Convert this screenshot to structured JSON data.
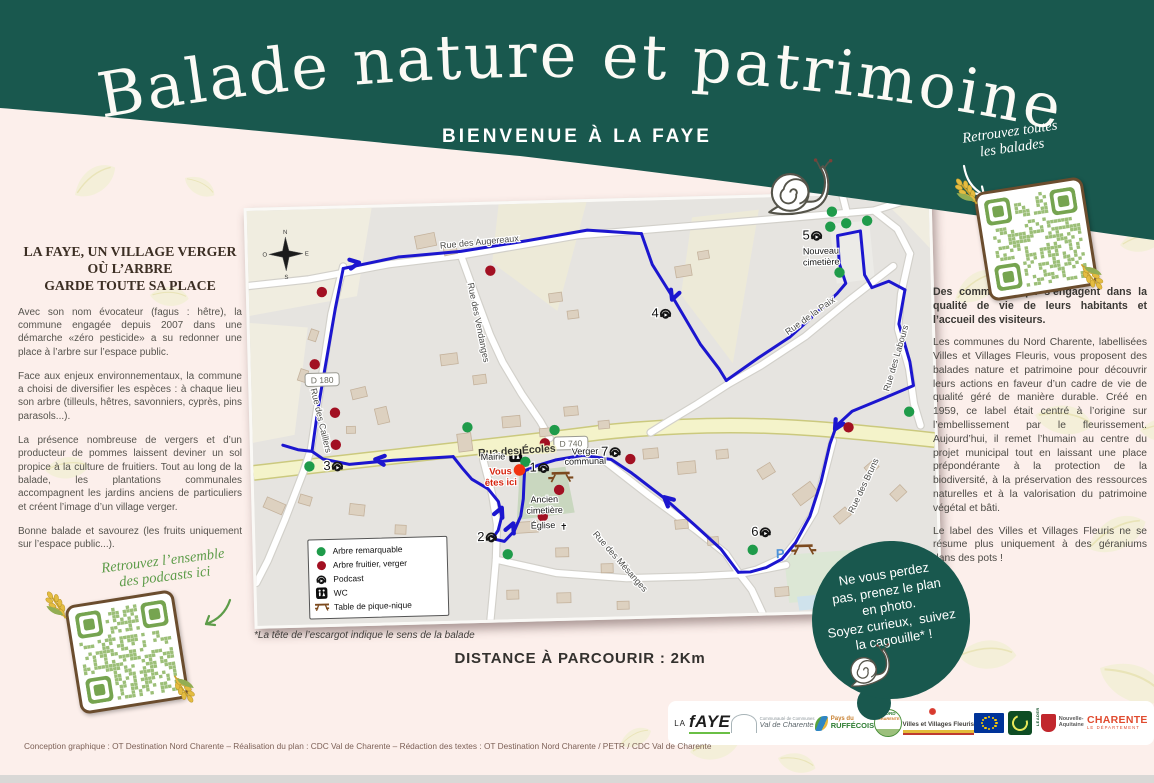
{
  "header": {
    "title": "Balade nature et patrimoine",
    "subtitle": "BIENVENUE À LA FAYE",
    "qr_note_lines": [
      "Retrouvez toutes",
      "les balades"
    ]
  },
  "left_panel": {
    "heading_lines": [
      "LA FAYE, UN VILLAGE VERGER",
      "OÙ L’ARBRE",
      "GARDE TOUTE SA PLACE"
    ],
    "paragraphs": [
      "Avec son nom évocateur (fagus : hêtre), la commune engagée depuis 2007 dans une démarche «zéro pesticide» a su redonner une place à l’arbre sur l’espace public.",
      "Face aux enjeux environnementaux, la commune a choisi de diversifier les espèces : à chaque lieu son arbre (tilleuls, hêtres, savonniers, cyprès, pins parasols...).",
      "La présence nombreuse de vergers et d’un producteur de pommes laissent deviner un sol propice à la culture de fruitiers. Tout au long de la balade, les plantations communales accompagnent les jardins anciens de particuliers et créent l’image d’un village verger.",
      "Bonne balade et savourez (les fruits uniquement sur l’espace public...)."
    ],
    "podcast_note_lines": [
      "Retrouvez l’ensemble",
      "des podcasts ici"
    ]
  },
  "right_panel": {
    "intro": "Des communes qui s’engagent dans la qualité de vie de leurs habitants et l’accueil des visiteurs.",
    "body": "Les communes du Nord Charente, labellisées Villes et Villages Fleuris, vous proposent des balades nature et patrimoine pour découvrir leurs actions en faveur d’un cadre de vie de qualité géré de manière durable. Créé en 1959, ce label était centré à l’origine sur l’embellissement par le fleurissement. Aujourd’hui, il remet l’humain au centre du projet municipal tout en laissant une place prépondérante à la protection de la biodiversité, à la préservation des ressources naturelles et à la valorisation du patrimoine végétal et bâti.",
    "outro": "Le label des Villes et Villages Fleuris ne se résume plus uniquement à des géraniums dans des pots !"
  },
  "notes": {
    "footnote": "*La tête de l’escargot indique le sens de la balade",
    "distance": "DISTANCE À PARCOURIR : 2Km"
  },
  "badge_circle": {
    "lines": [
      "Ne vous perdez",
      "pas, prenez le plan",
      "en photo.",
      "Soyez curieux,  suivez",
      "la cagouille* !"
    ]
  },
  "footer": {
    "credits": "Conception graphique : OT Destination Nord Charente – Réalisation du plan : CDC  Val de Charente – Rédaction des textes : OT Destination Nord Charente / PETR / CDC Val de Charente",
    "logos": [
      {
        "id": "lafaye",
        "lines": [
          "LA",
          "fAYE"
        ]
      },
      {
        "id": "valcharente",
        "lines": [
          "Communauté de Communes",
          "Val de Charente"
        ]
      },
      {
        "id": "ruffecois",
        "lines": [
          "Pays du",
          "RUFFÉCOIS"
        ]
      },
      {
        "id": "nordcharente",
        "lines": [
          "NORD",
          "CHARENTE"
        ]
      },
      {
        "id": "fleuris",
        "lines": [
          "Villes et Villages Fleuris"
        ]
      },
      {
        "id": "eu",
        "lines": []
      },
      {
        "id": "leader",
        "lines": [
          "LEADER"
        ]
      },
      {
        "id": "naquitaine",
        "lines": [
          "Nouvelle-",
          "Aquitaine"
        ]
      },
      {
        "id": "charente",
        "lines": [
          "CHARENTE",
          "LE DÉPARTEMENT"
        ]
      }
    ]
  },
  "colors": {
    "teal": "#19584e",
    "route_blue": "#1c16cf",
    "tree_green": "#1f9b4a",
    "fruit_red": "#a21022",
    "you_are_here_red": "#f2330f",
    "yellow_road": "#f4f3ca",
    "handwriting_green": "#5d9c49"
  },
  "map": {
    "fields": [
      {
        "pts": "0,0 125,0 108,88 0,105",
        "c": "#f0ede0"
      },
      {
        "pts": "0,112 58,118 42,225 0,232",
        "c": "#f0ede0"
      },
      {
        "pts": "252,0 340,0 308,108 244,58",
        "c": "#edead8"
      },
      {
        "pts": "445,18 512,12 482,165 432,95",
        "c": "#edead8"
      },
      {
        "pts": "630,0 682,0 682,55 655,25",
        "c": "#f0ede0"
      },
      {
        "pts": "582,28 622,26 626,84 588,88",
        "c": "#ecebe7"
      },
      {
        "pts": "528,358 648,352 652,400 532,406",
        "c": "#dce7d5"
      },
      {
        "pts": "540,400 568,398 570,412 542,414",
        "c": "#cfe2ec"
      },
      {
        "pts": "266,268 312,264 320,310 262,316",
        "c": "#c9d7bf"
      }
    ],
    "yellow_road": "M0,262 C150,248 260,240 345,231 C480,220 560,231 682,247",
    "roads": [
      "0,75 60,70 140,57 213,50 330,33 455,26 560,20 627,16",
      "627,16 650,35 662,60",
      "627,16 655,8 682,6",
      "600,18 596,0",
      "662,60 652,100 648,135 658,175 662,210 668,232",
      "580,245 570,280 560,315 542,343 528,360 500,372 482,376",
      "645,72 600,105 555,140 510,168 478,185 445,205 415,222 398,232",
      "213,50 228,95 240,130 252,158 270,190 288,218 297,235",
      "95,58 82,105 74,150 66,195 58,240 50,262 30,310 12,350 0,372",
      "230,255 238,290 242,320 240,355 236,390 233,415",
      "240,355 300,370 370,377 440,377 482,376",
      "350,258 395,295 440,330 470,355 482,374 495,392 505,415",
      "482,376 530,368"
    ],
    "buildings": [
      [
        168,
        28,
        20,
        13,
        -10
      ],
      [
        196,
        40,
        13,
        9,
        -10
      ],
      [
        300,
        90,
        13,
        9,
        -6
      ],
      [
        318,
        108,
        11,
        8,
        -6
      ],
      [
        427,
        66,
        16,
        11,
        -8
      ],
      [
        450,
        52,
        11,
        8,
        -8
      ],
      [
        58,
        122,
        11,
        8,
        -70
      ],
      [
        46,
        162,
        12,
        8,
        -70
      ],
      [
        100,
        180,
        15,
        10,
        -12
      ],
      [
        124,
        200,
        12,
        16,
        -12
      ],
      [
        94,
        218,
        9,
        7,
        0
      ],
      [
        10,
        290,
        20,
        11,
        25
      ],
      [
        45,
        286,
        12,
        9,
        18
      ],
      [
        95,
        296,
        15,
        11,
        8
      ],
      [
        140,
        318,
        11,
        9,
        4
      ],
      [
        174,
        334,
        13,
        10,
        2
      ],
      [
        190,
        148,
        17,
        11,
        -6
      ],
      [
        222,
        170,
        13,
        9,
        -6
      ],
      [
        250,
        212,
        18,
        11,
        -4
      ],
      [
        287,
        225,
        12,
        8,
        -4
      ],
      [
        205,
        228,
        14,
        18,
        -6
      ],
      [
        312,
        204,
        14,
        9,
        -4
      ],
      [
        346,
        219,
        11,
        8,
        -4
      ],
      [
        390,
        248,
        15,
        10,
        -4
      ],
      [
        424,
        262,
        18,
        12,
        -4
      ],
      [
        463,
        251,
        12,
        9,
        -4
      ],
      [
        505,
        268,
        15,
        11,
        -30
      ],
      [
        540,
        290,
        22,
        14,
        -35
      ],
      [
        580,
        315,
        15,
        10,
        -38
      ],
      [
        612,
        268,
        12,
        9,
        -40
      ],
      [
        637,
        294,
        14,
        10,
        -42
      ],
      [
        258,
        318,
        25,
        11,
        -2
      ],
      [
        300,
        345,
        13,
        9,
        0
      ],
      [
        345,
        362,
        12,
        9,
        0
      ],
      [
        250,
        386,
        12,
        9,
        0
      ],
      [
        300,
        390,
        14,
        10,
        0
      ],
      [
        420,
        320,
        13,
        9,
        -4
      ],
      [
        452,
        338,
        11,
        8,
        -4
      ],
      [
        360,
        400,
        12,
        8,
        0
      ],
      [
        518,
        390,
        14,
        9,
        -3
      ],
      [
        642,
        362,
        16,
        11,
        -40
      ],
      [
        660,
        392,
        12,
        9,
        -40
      ]
    ],
    "route": [
      [
        [
          95,
          60
        ],
        [
          86,
          100
        ],
        [
          76,
          150
        ],
        [
          66,
          200
        ],
        [
          59,
          242
        ]
      ],
      [
        [
          30,
          235
        ],
        [
          45,
          240
        ],
        [
          59,
          242
        ],
        [
          70,
          250
        ],
        [
          96,
          256
        ],
        [
          140,
          253
        ],
        [
          200,
          251
        ]
      ],
      [
        [
          95,
          60
        ],
        [
          150,
          50
        ],
        [
          213,
          46
        ],
        [
          280,
          37
        ],
        [
          340,
          28
        ],
        [
          394,
          33
        ]
      ],
      [
        [
          394,
          33
        ],
        [
          404,
          64
        ],
        [
          424,
          98
        ],
        [
          450,
          145
        ],
        [
          468,
          170
        ],
        [
          475,
          182
        ]
      ],
      [
        [
          475,
          182
        ],
        [
          508,
          160
        ],
        [
          540,
          140
        ],
        [
          568,
          116
        ],
        [
          588,
          98
        ],
        [
          597,
          88
        ],
        [
          591,
          68
        ],
        [
          590,
          40
        ],
        [
          613,
          36
        ],
        [
          616,
          80
        ],
        [
          623,
          93
        ],
        [
          640,
          87
        ],
        [
          656,
          96
        ]
      ],
      [
        [
          656,
          96
        ],
        [
          649,
          130
        ],
        [
          659,
          168
        ],
        [
          662,
          192
        ],
        [
          634,
          203
        ],
        [
          600,
          216
        ],
        [
          584,
          230
        ],
        [
          577,
          248
        ],
        [
          567,
          286
        ],
        [
          555,
          320
        ],
        [
          540,
          346
        ],
        [
          526,
          362
        ],
        [
          510,
          370
        ],
        [
          494,
          374
        ],
        [
          482,
          374
        ]
      ],
      [
        [
          482,
          374
        ],
        [
          465,
          350
        ],
        [
          440,
          326
        ],
        [
          410,
          298
        ],
        [
          378,
          272
        ],
        [
          358,
          258
        ],
        [
          330,
          253
        ],
        [
          302,
          257
        ],
        [
          284,
          262
        ],
        [
          271,
          267
        ]
      ],
      [
        [
          200,
          251
        ],
        [
          209,
          263
        ],
        [
          218,
          274
        ],
        [
          234,
          284
        ],
        [
          244,
          297
        ],
        [
          247,
          312
        ],
        [
          243,
          326
        ],
        [
          237,
          334
        ],
        [
          249,
          337
        ],
        [
          259,
          327
        ],
        [
          266,
          312
        ],
        [
          269,
          295
        ],
        [
          270,
          280
        ],
        [
          271,
          267
        ]
      ]
    ],
    "arrows": [
      [
        108,
        55,
        -8
      ],
      [
        125,
        252,
        188
      ],
      [
        424,
        97,
        112
      ],
      [
        584,
        231,
        122
      ],
      [
        412,
        299,
        223
      ],
      [
        246,
        306,
        -65
      ],
      [
        257,
        322,
        -65
      ]
    ],
    "green_dots": [
      [
        585,
        16
      ],
      [
        599,
        28
      ],
      [
        620,
        26
      ],
      [
        583,
        31
      ],
      [
        591,
        77
      ],
      [
        215,
        222
      ],
      [
        302,
        227
      ],
      [
        272,
        258
      ],
      [
        252,
        350
      ],
      [
        56,
        257
      ],
      [
        497,
        352
      ],
      [
        657,
        218
      ]
    ],
    "red_dots": [
      [
        73,
        83
      ],
      [
        64,
        155
      ],
      [
        83,
        204
      ],
      [
        83,
        236
      ],
      [
        242,
        66
      ],
      [
        292,
        240
      ],
      [
        305,
        287
      ],
      [
        288,
        313
      ],
      [
        377,
        258
      ],
      [
        596,
        232
      ]
    ],
    "you_are_here": [
      266,
      266
    ],
    "you_are_here_label": [
      "Vous",
      "êtes ici"
    ],
    "streets": [
      {
        "t": "Rue des Augereaux",
        "x": 232,
        "y": 40,
        "r": -4
      },
      {
        "t": "Rue des Vendanges",
        "x": 226,
        "y": 118,
        "r": 80
      },
      {
        "t": "Rue de la Paix",
        "x": 562,
        "y": 122,
        "r": -34
      },
      {
        "t": "Rue des Labours",
        "x": 648,
        "y": 165,
        "r": -72
      },
      {
        "t": "Rue des Écoles",
        "x": 264,
        "y": 250,
        "r": -2,
        "b": 1
      },
      {
        "t": "Rue des Caillers",
        "x": 66,
        "y": 212,
        "r": 78
      },
      {
        "t": "Rue des Mésanges",
        "x": 362,
        "y": 362,
        "r": 50
      },
      {
        "t": "Rue des Bruns",
        "x": 612,
        "y": 292,
        "r": -63
      }
    ],
    "badges": [
      {
        "t": "D 740",
        "x": 318,
        "y": 243
      },
      {
        "t": "D 180",
        "x": 71,
        "y": 173
      }
    ],
    "places": [
      {
        "t": "Mairie",
        "x": 252,
        "y": 255,
        "a": "end"
      },
      {
        "t": "Verger",
        "x": 332,
        "y": 252,
        "a": "middle"
      },
      {
        "t": "communal",
        "x": 332,
        "y": 262,
        "a": "middle"
      },
      {
        "t": "Nouveau",
        "x": 573,
        "y": 58,
        "a": "middle"
      },
      {
        "t": "cimetière",
        "x": 573,
        "y": 69,
        "a": "middle"
      },
      {
        "t": "Ancien",
        "x": 290,
        "y": 299,
        "a": "middle"
      },
      {
        "t": "cimetière",
        "x": 290,
        "y": 310,
        "a": "middle"
      },
      {
        "t": "Église",
        "x": 288,
        "y": 325,
        "a": "middle"
      }
    ],
    "church_cross": {
      "x": 305,
      "y": 327
    },
    "parking": {
      "t": "P",
      "x": 520,
      "y": 361
    },
    "points": [
      [
        1,
        276,
        268
      ],
      [
        2,
        222,
        336
      ],
      [
        3,
        70,
        261
      ],
      [
        4,
        402,
        117
      ],
      [
        5,
        555,
        43
      ],
      [
        6,
        496,
        338
      ],
      [
        7,
        348,
        254
      ]
    ],
    "picnics": [
      [
        307,
        272
      ],
      [
        548,
        351
      ]
    ],
    "wc": [
      256,
      245
    ],
    "compass": {
      "x": 38,
      "y": 44,
      "n": "N",
      "s": "S",
      "e": "E",
      "o": "O"
    },
    "legend": {
      "items": [
        {
          "icon": "green",
          "label": "Arbre remarquable"
        },
        {
          "icon": "red",
          "label": "Arbre fruitier, verger"
        },
        {
          "icon": "podcast",
          "label": "Podcast"
        },
        {
          "icon": "wc",
          "label": "WC"
        },
        {
          "icon": "picnic",
          "label": "Table de pique-nique"
        }
      ]
    }
  }
}
